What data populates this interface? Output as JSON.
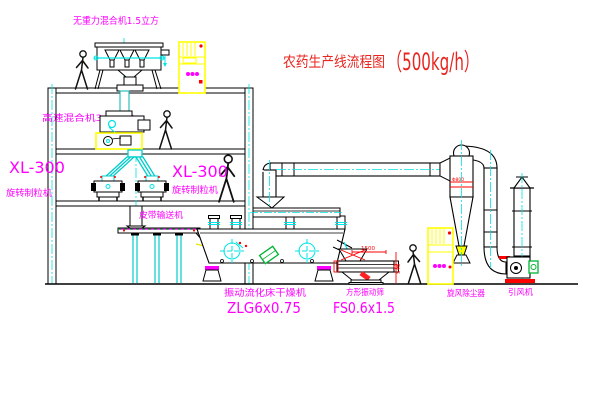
{
  "title": {
    "name": "农药生产线流程图",
    "capacity": "（500kg/h）"
  },
  "equipment_labels": {
    "gravity_free_mixer": "无重力混合机1.5立方",
    "high_speed_mixer": "高速混合机3.5立方",
    "granulator_left": {
      "model": "XL-300",
      "name": "旋转制粒机"
    },
    "granulator_right": {
      "model": "XL-300",
      "name": "旋转制粒机"
    },
    "belt_conveyor": "皮带输送机",
    "fluid_bed_dryer": {
      "name": "振动流化床干燥机",
      "model": "ZLG6x0.75"
    },
    "vibrating_sieve": {
      "name": "方形振动筛",
      "model": "FS0.6x1.5"
    },
    "cyclone": "旋风除尘器",
    "induced_draft_fan": "引风机"
  },
  "dimensions": {
    "sieve_length": "1500",
    "sieve_height": "545",
    "cyclone_diameter": "Φ800"
  },
  "colors": {
    "label_magenta": "#ff00ff",
    "title_red": "#e8251f",
    "accent_red": "#ff0000",
    "centerline_cyan": "#00e5e5",
    "highlight_yellow": "#ffff00",
    "accent_green": "#00b332",
    "line_black": "#000000"
  }
}
